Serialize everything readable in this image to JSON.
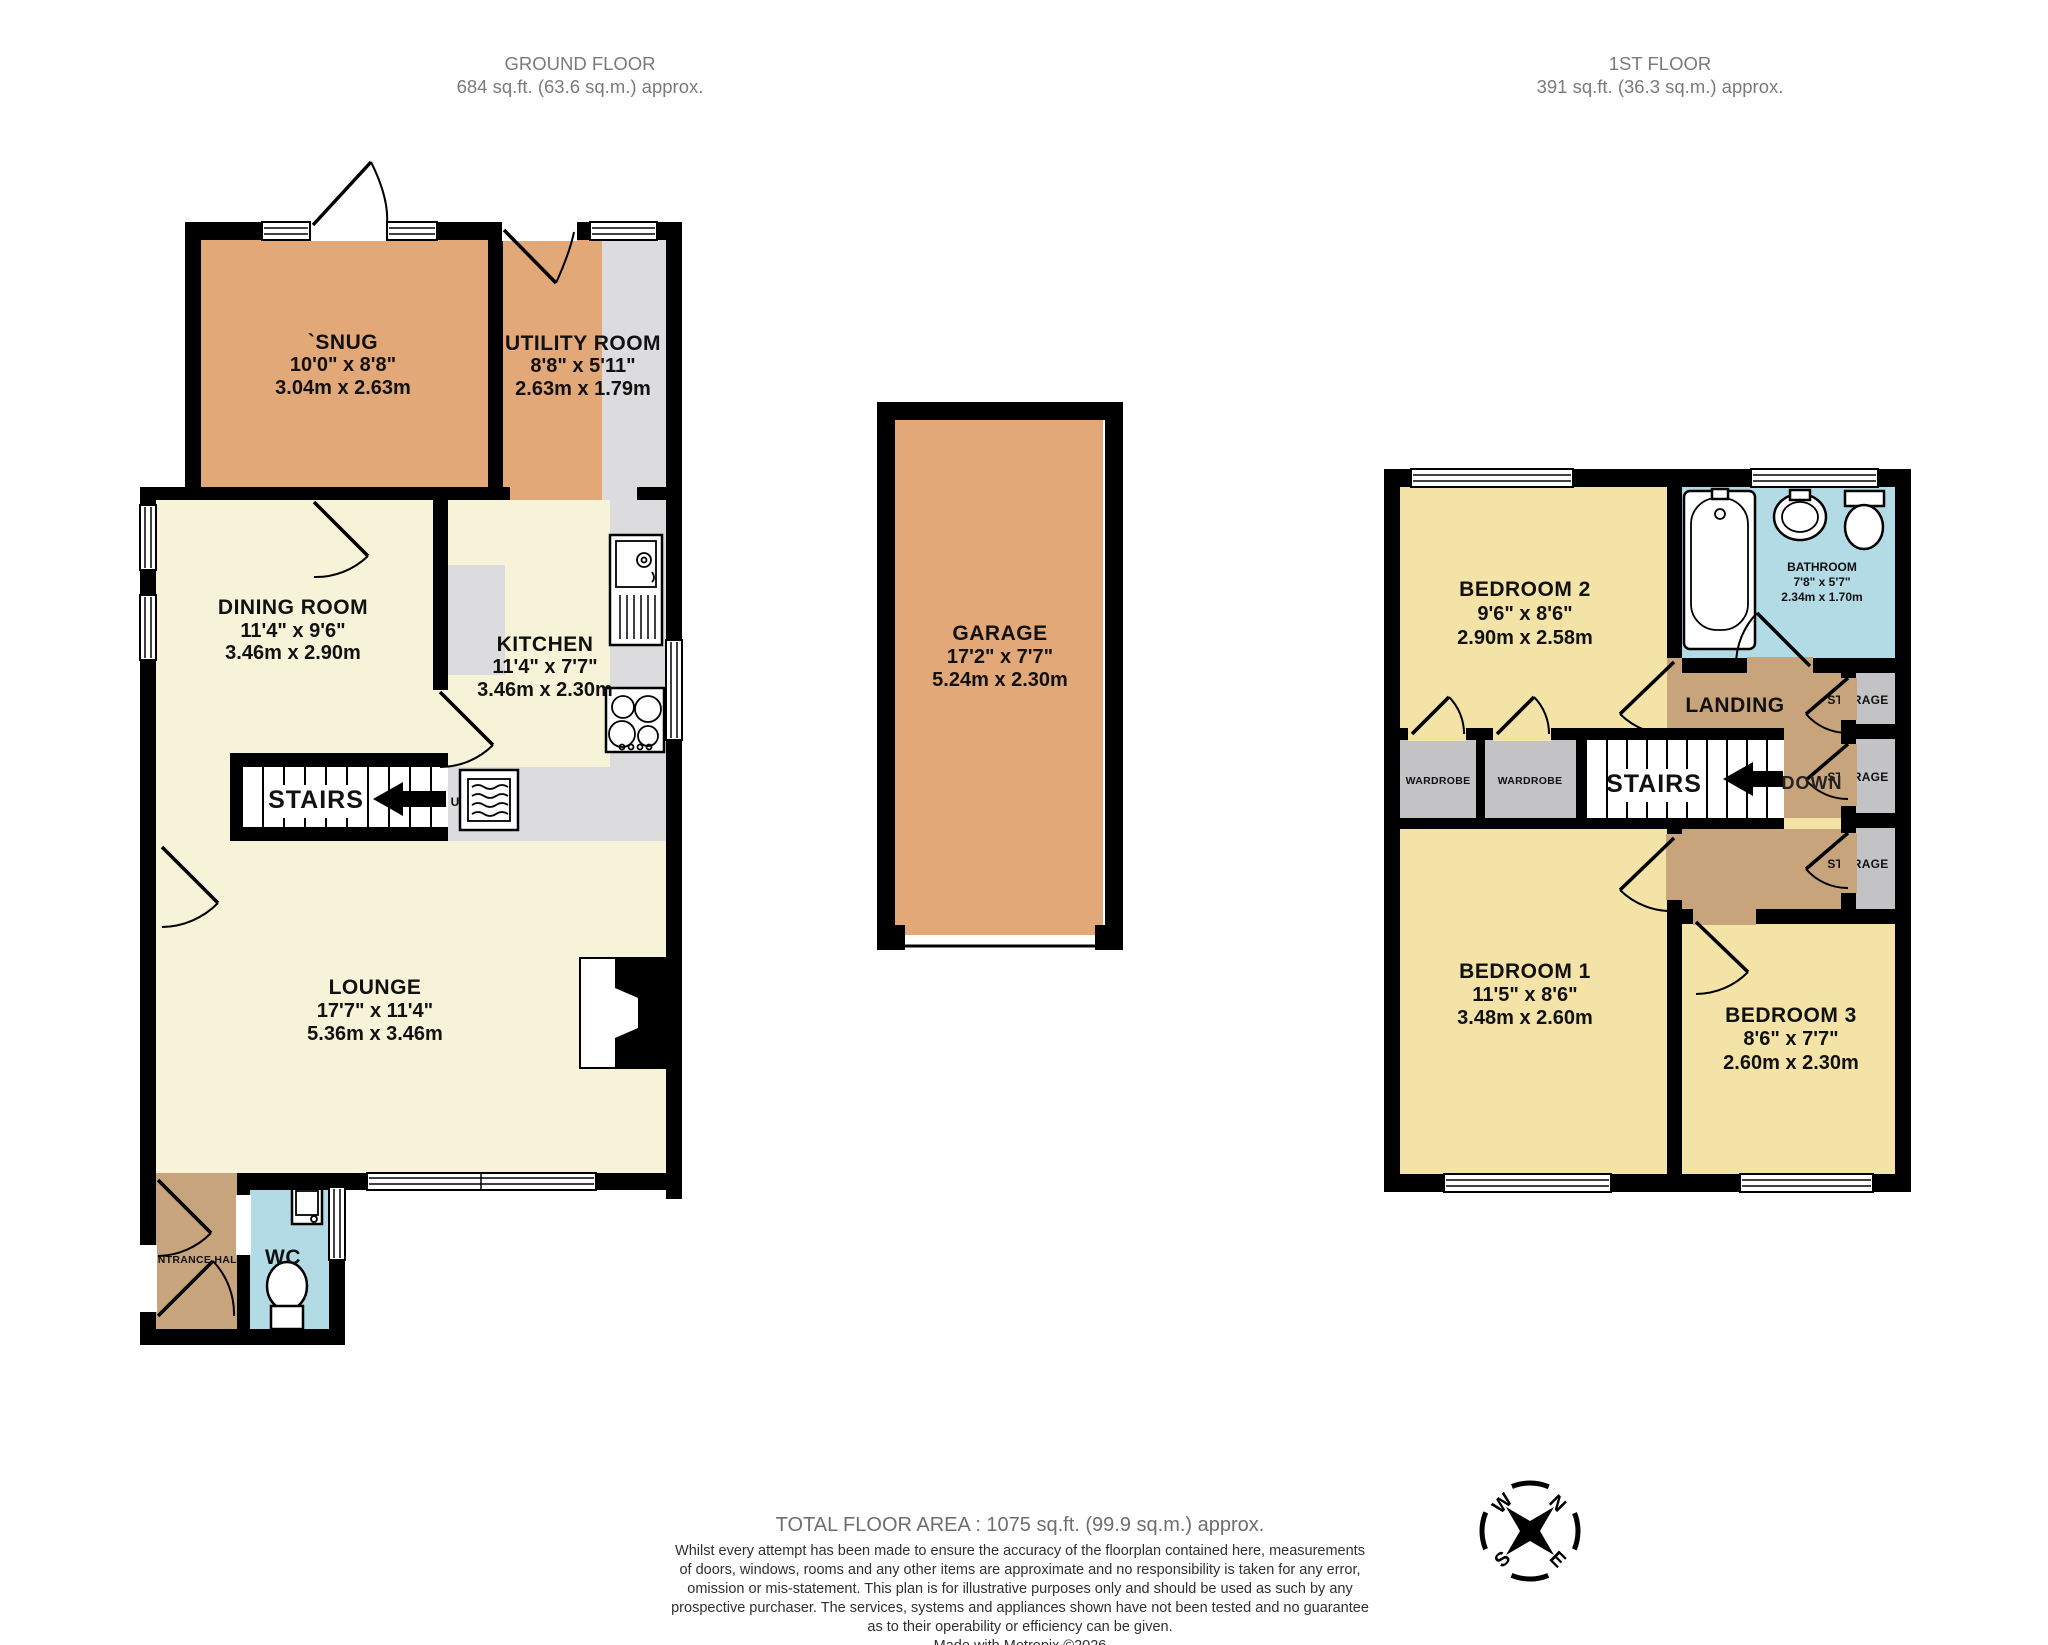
{
  "headers": {
    "ground": {
      "line1": "GROUND FLOOR",
      "line2": "684 sq.ft. (63.6 sq.m.) approx."
    },
    "first": {
      "line1": "1ST FLOOR",
      "line2": "391 sq.ft. (36.3 sq.m.) approx."
    }
  },
  "rooms": {
    "snug": {
      "name": "`SNUG",
      "imperial": "10'0\" x 8'8\"",
      "metric": "3.04m x 2.63m"
    },
    "utility": {
      "name": "UTILITY ROOM",
      "imperial": "8'8\" x 5'11\"",
      "metric": "2.63m x 1.79m"
    },
    "dining": {
      "name": "DINING ROOM",
      "imperial": "11'4\" x 9'6\"",
      "metric": "3.46m x 2.90m"
    },
    "kitchen": {
      "name": "KITCHEN",
      "imperial": "11'4\" x 7'7\"",
      "metric": "3.46m x 2.30m"
    },
    "lounge": {
      "name": "LOUNGE",
      "imperial": "17'7\" x 11'4\"",
      "metric": "5.36m x 3.46m"
    },
    "garage": {
      "name": "GARAGE",
      "imperial": "17'2\" x 7'7\"",
      "metric": "5.24m x 2.30m"
    },
    "bedroom2": {
      "name": "BEDROOM 2",
      "imperial": "9'6\" x 8'6\"",
      "metric": "2.90m x 2.58m"
    },
    "bathroom": {
      "name": "BATHROOM",
      "imperial": "7'8\" x 5'7\"",
      "metric": "2.34m x 1.70m"
    },
    "bedroom1": {
      "name": "BEDROOM 1",
      "imperial": "11'5\" x 8'6\"",
      "metric": "3.48m x 2.60m"
    },
    "bedroom3": {
      "name": "BEDROOM 3",
      "imperial": "8'6\" x 7'7\"",
      "metric": "2.60m x 2.30m"
    }
  },
  "labels": {
    "stairs": "STAIRS",
    "down": "DOWN",
    "up": "U",
    "wardrobe": "WARDROBE",
    "storage": "STORAGE",
    "wc": "WC",
    "entrance_hall": "ENTRANCE HALL",
    "landing": "LANDING"
  },
  "compass": {
    "n": "N",
    "e": "E",
    "s": "S",
    "w": "W"
  },
  "footer": {
    "total": "TOTAL FLOOR AREA : 1075 sq.ft. (99.9 sq.m.) approx.",
    "disclaimer_lines": [
      "Whilst every attempt has been made to ensure the accuracy of the floorplan contained here, measurements",
      "of doors, windows, rooms and any other items are approximate and no responsibility is taken for any error,",
      "omission or mis-statement. This plan is for illustrative purposes only and should be used as such by any",
      "prospective purchaser. The services, systems and appliances shown have not been tested and no guarantee",
      "as to their operability or efficiency can be given."
    ],
    "credit": "Made with Metropix ©2026"
  },
  "colors": {
    "room_tan": "#e3a877",
    "room_cream": "#f7f3d8",
    "room_yellow": "#f3e3a7",
    "hall_brown": "#c7a47c",
    "wet_blue": "#b3dbe6",
    "closet_gray": "#c3c3c5",
    "counter_gray": "#dcdcde",
    "wall_black": "#000000",
    "header_gray": "#7a7a7a",
    "disclaimer_gray": "#2f2f2f"
  }
}
